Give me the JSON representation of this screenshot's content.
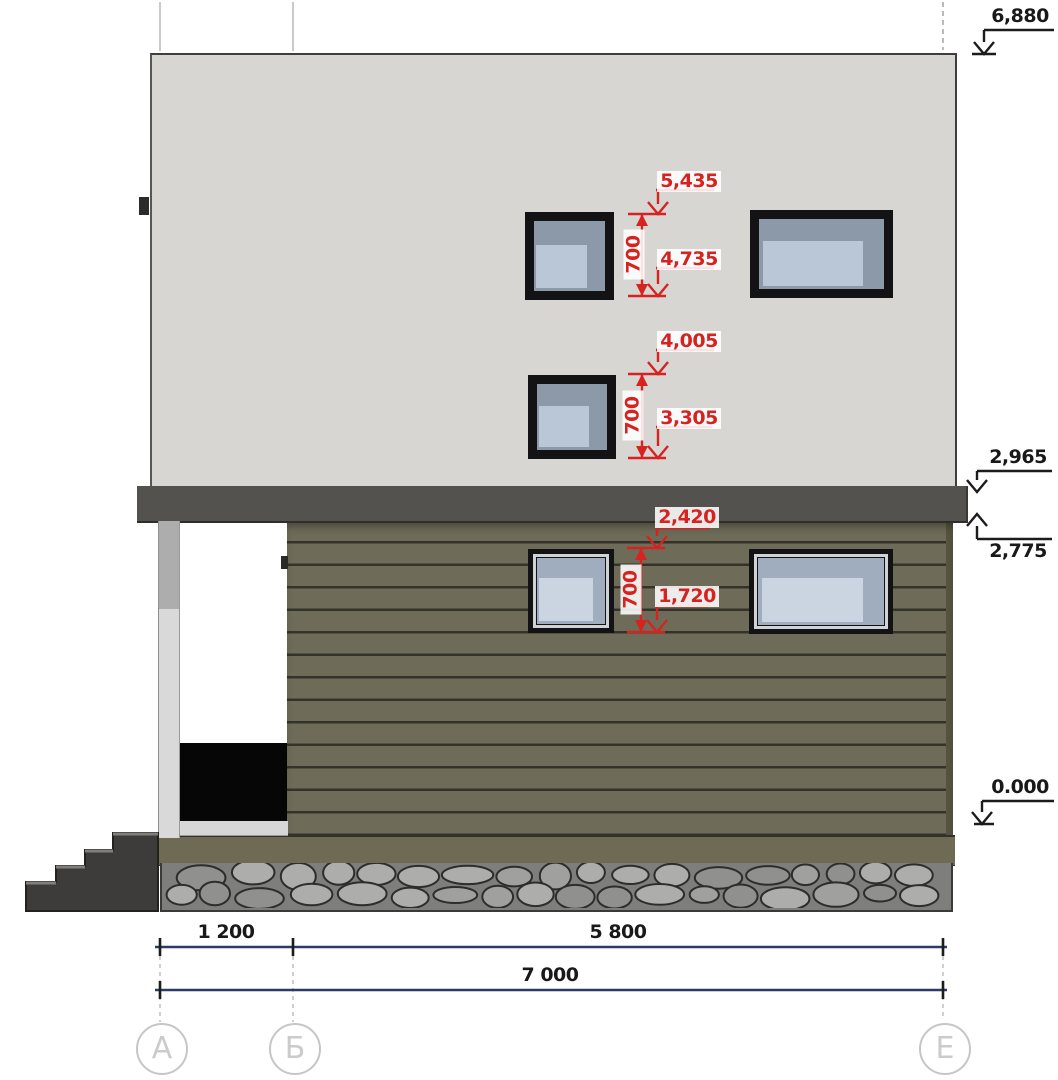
{
  "drawing": {
    "type_label": "house-side-elevation",
    "accent_red": "#d6231f",
    "dim_line_navy": "#2c3a68",
    "siding_color": "#6e6c58",
    "upper_wall_color": "#d7d6d3"
  },
  "red_dims": [
    {
      "top": "5,435",
      "span": "700",
      "bottom": "4,735"
    },
    {
      "top": "4,005",
      "span": "700",
      "bottom": "3,305"
    },
    {
      "top": "2,420",
      "span": "700",
      "bottom": "1,720"
    }
  ],
  "levels": {
    "roof": "6,880",
    "slab_top": "2,965",
    "slab_bottom": "2,775",
    "ground": "0.000"
  },
  "bottom_dims": {
    "seg_a_b": "1 200",
    "seg_b_e": "5 800",
    "total": "7 000"
  },
  "axes": {
    "a": "А",
    "b": "Б",
    "e": "Е"
  }
}
